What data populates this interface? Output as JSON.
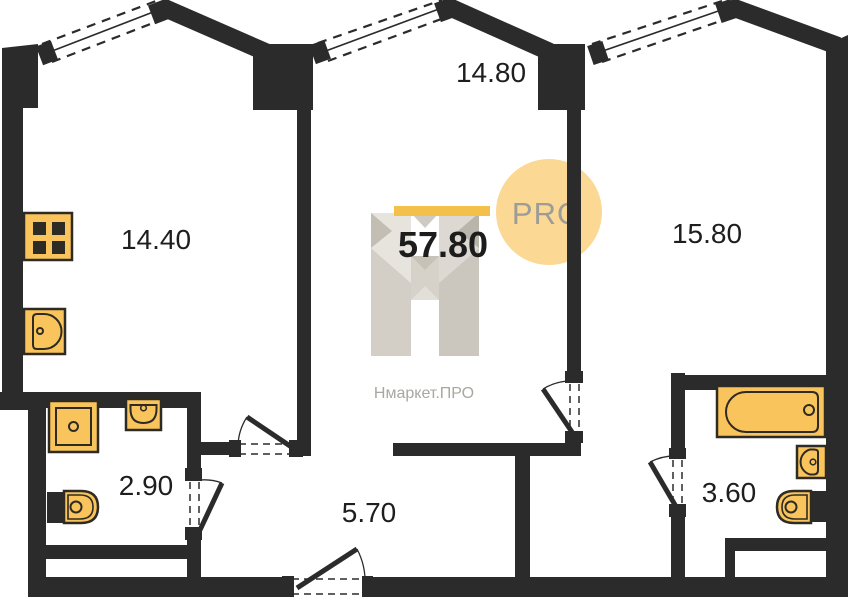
{
  "plan": {
    "total_area": "57.80",
    "rooms": [
      {
        "name": "room-left",
        "area": "14.40"
      },
      {
        "name": "room-middle",
        "area": "14.80"
      },
      {
        "name": "room-right",
        "area": "15.80"
      },
      {
        "name": "bathroom-left",
        "area": "2.90"
      },
      {
        "name": "hallway",
        "area": "5.70"
      },
      {
        "name": "bathroom-right",
        "area": "3.60"
      }
    ],
    "colors": {
      "wall": "#2b2b2b",
      "fixture_fill": "#f9c45c",
      "fixture_stroke": "#2e2a24"
    },
    "fixture_icons": [
      "stove-icon",
      "kitchen-sink-icon",
      "shower-icon",
      "washbasin-icon",
      "toilet-icon",
      "bathtub-icon"
    ]
  },
  "branding": {
    "badge": "PRO",
    "watermark": "Нмаркет.ПРО",
    "bar_color": "#f3c14b",
    "badge_circle_color": "#fbd893",
    "badge_text_color": "#9c9c98",
    "logo_facet_colors": [
      "#e7e4de",
      "#d3cfc7",
      "#c2beb4",
      "#ddd9d2",
      "#cbc7be",
      "#b9b5ab"
    ]
  }
}
